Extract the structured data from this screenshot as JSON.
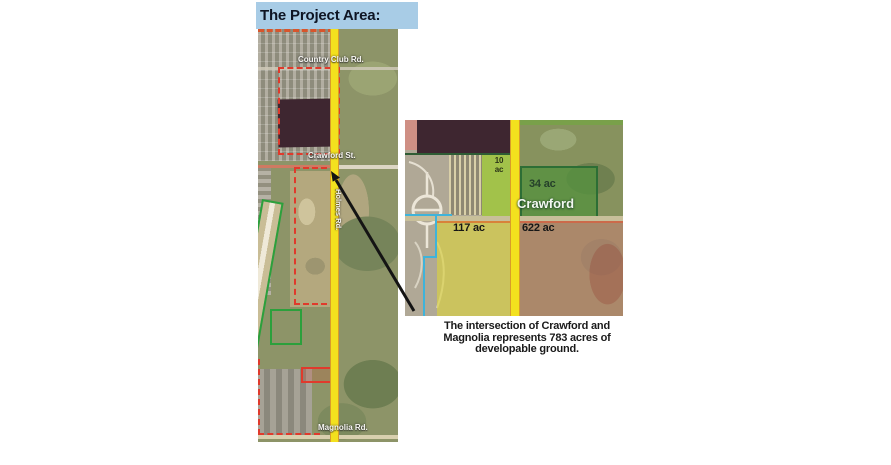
{
  "banner": {
    "title": "The Project Area:"
  },
  "main_map": {
    "roads": {
      "country_club": "Country Club Rd.",
      "crawford": "Crawford St.",
      "holmes": "Holmes Rd.",
      "magnolia": "Magnolia Rd."
    }
  },
  "inset_map": {
    "road_label": "Crawford",
    "parcels": [
      {
        "label": "10 ac",
        "color": "#9dc93c"
      },
      {
        "label": "34 ac",
        "color": "#55913f"
      },
      {
        "label": "117 ac",
        "color": "#d6cf52"
      },
      {
        "label": "622 ac",
        "color": "#c98f8a"
      }
    ]
  },
  "caption": {
    "lines": [
      "The intersection of Crawford and",
      "Magnolia represents 783 acres of",
      "developable ground."
    ]
  },
  "colors": {
    "banner_bg": "#a8cce6",
    "road_yellow": "#f3e11e",
    "parcel_outline_red": "#e03a2c",
    "parcel_outline_green": "#2ca03c",
    "boundary_cyan": "#3fb3da"
  }
}
